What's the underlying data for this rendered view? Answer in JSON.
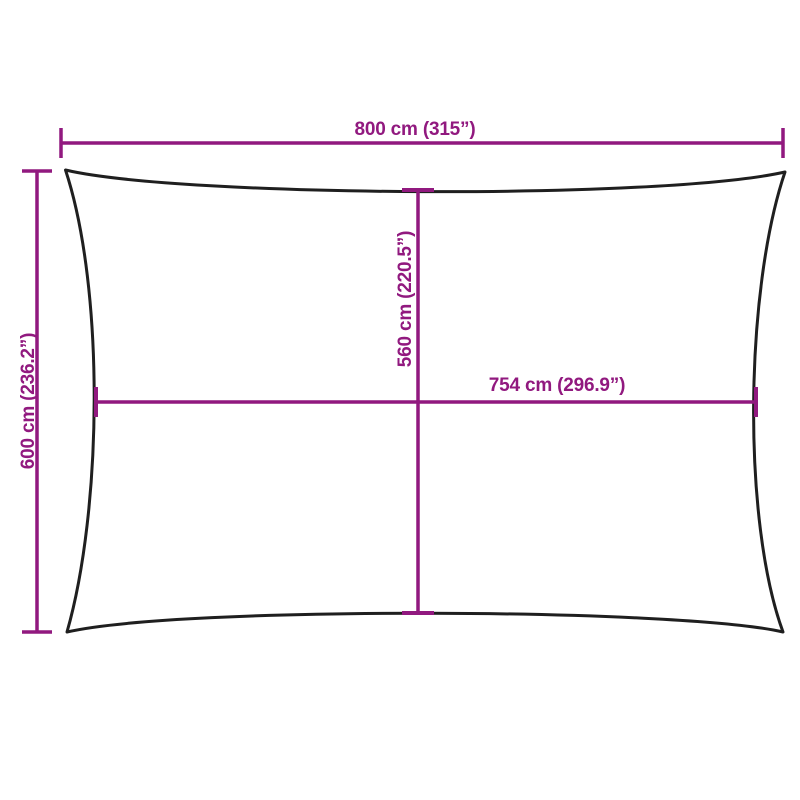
{
  "colors": {
    "dimension": "#91197F",
    "outline": "#1F1F1F",
    "background": "#FFFFFF"
  },
  "dimensions": {
    "overall_width": {
      "cm": "800",
      "inches": "315",
      "label": "800 cm (315”)"
    },
    "overall_height": {
      "cm": "600",
      "inches": "236.2",
      "label": "600 cm (236.2”)"
    },
    "inner_height": {
      "cm": "560",
      "inches": "220.5",
      "label": "560 cm (220.5”)"
    },
    "inner_width": {
      "cm": "754",
      "inches": "296.9",
      "label": "754 cm (296.9”)"
    }
  }
}
